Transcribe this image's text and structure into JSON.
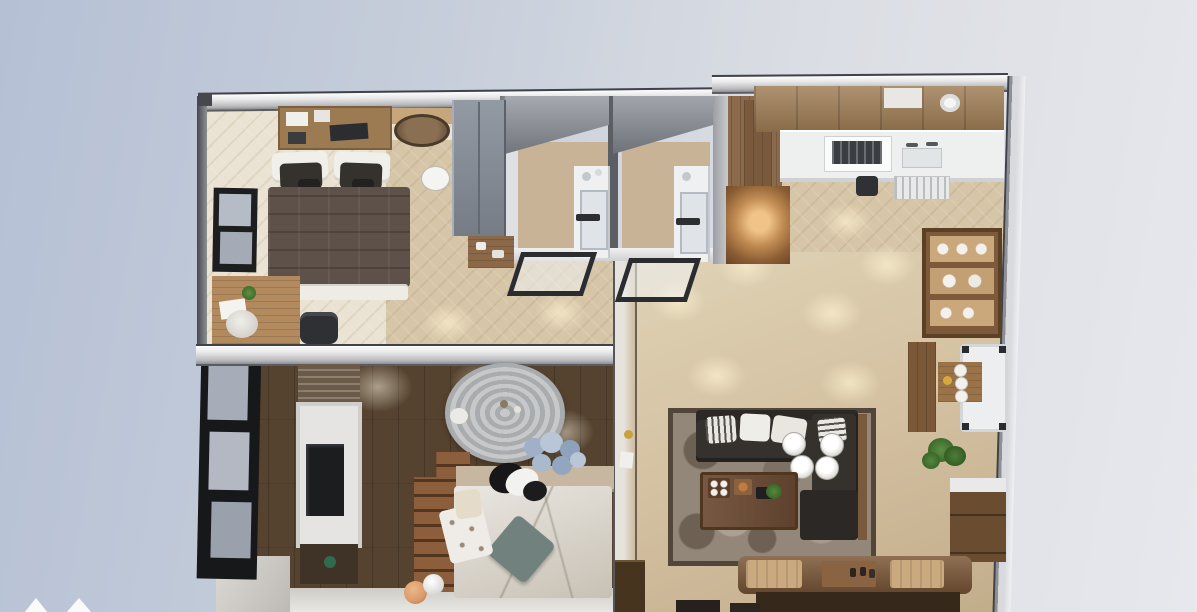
{
  "title": "3D apartment floor plan, top-down dollhouse render",
  "scene": {
    "view": "top-down 3d render of a two-bedroom apartment on a pale blue studio backdrop",
    "rooms": [
      {
        "name": "master-bedroom",
        "position": "top-left",
        "furniture": [
          "double-bed",
          "white-pillows",
          "dark-cushions",
          "brown-blanket",
          "wall-shelf-unit",
          "side-counter",
          "round-wall-mirror",
          "wall-clock",
          "gray-wardrobe",
          "open-shelf",
          "window",
          "desk",
          "desk-chair",
          "office-chair",
          "potted-plant"
        ]
      },
      {
        "name": "bathroom-1",
        "position": "top-center-left",
        "furniture": [
          "shower-column",
          "door-panel",
          "glass-screen",
          "sloped-ceiling"
        ]
      },
      {
        "name": "bathroom-2",
        "position": "top-center-right",
        "furniture": [
          "shower-column",
          "door-panel",
          "glass-screen",
          "sloped-ceiling"
        ]
      },
      {
        "name": "entry-hall",
        "position": "top-center",
        "furniture": [
          "wood-paneling",
          "lit-display-cabinet"
        ]
      },
      {
        "name": "kitchen",
        "position": "top-right",
        "furniture": [
          "upper-wood-cabinets",
          "white-countertop",
          "stove-oven",
          "sink-faucets",
          "dish-rack",
          "kettle",
          "round-ceiling-light"
        ]
      },
      {
        "name": "living-dining-room",
        "position": "right",
        "furniture": [
          "l-shaped-dark-sofa",
          "throw-pillows",
          "ornate-area-rug",
          "wood-coffee-table",
          "serving-tray",
          "remote",
          "small-plant",
          "ceiling-chandelier",
          "display-hutch-with-dishes",
          "white-bench-table",
          "plate-side-table",
          "potted-plant",
          "drawer-cabinet",
          "dining-table",
          "placemats",
          "bench",
          "stools",
          "divider-console"
        ]
      },
      {
        "name": "second-bedroom",
        "position": "bottom-left",
        "furniture": [
          "bed-with-marble-duvet",
          "teal-pillow",
          "dotted-blanket",
          "cream-pillow",
          "headboard-shelf",
          "hydrangea-bouquet",
          "dog-on-bed",
          "round-silver-rug",
          "staircase",
          "tv-wall-unit",
          "slatted-panel",
          "media-shelf",
          "toy-balls",
          "black-framed-glass-wall"
        ]
      }
    ],
    "background": "soft blue-gray gradient, lighter toward the right",
    "watermark": "two small white triangle peaks cut off at the bottom-left edge"
  },
  "colors": {
    "bg1": "#b5c0d5",
    "bg2": "#e7e8ed",
    "wall-dark": "#3f4247",
    "wall-gray": "#8f939a",
    "wall-white": "#f2f2f3",
    "floor1": "#eae2d2",
    "hall": "#d6c5a7",
    "bath-floor": "#c9b396",
    "living1": "#e0d3b6",
    "living2": "#c2ad8b",
    "floor-dark": "#56432f",
    "wood": "#9c7a52",
    "wood-dark": "#6e5037",
    "wood-light": "#c6a67a",
    "counter": "#eef0f0",
    "sofa": "#35322e",
    "sofa-dark": "#2b2825",
    "rug": "#93877a",
    "rug-border": "#52453a",
    "table": "#6b4a33",
    "dining": "#7b5737",
    "bench": "#36291b",
    "wardrobe": "#868c95",
    "glow-hi": "#f0c489",
    "glow-lo": "#6b4526",
    "duvet": "#d5cfc4",
    "teal": "#71817d",
    "silver": "#c0c2c4",
    "plant": "#45702f",
    "hydrangea": "#a4b5cc",
    "orange": "#d89a6a",
    "blanket": "#5e5149",
    "screen-frame": "#2b2c2f",
    "white": "#f0efec",
    "dark": "#1c1c1e"
  }
}
